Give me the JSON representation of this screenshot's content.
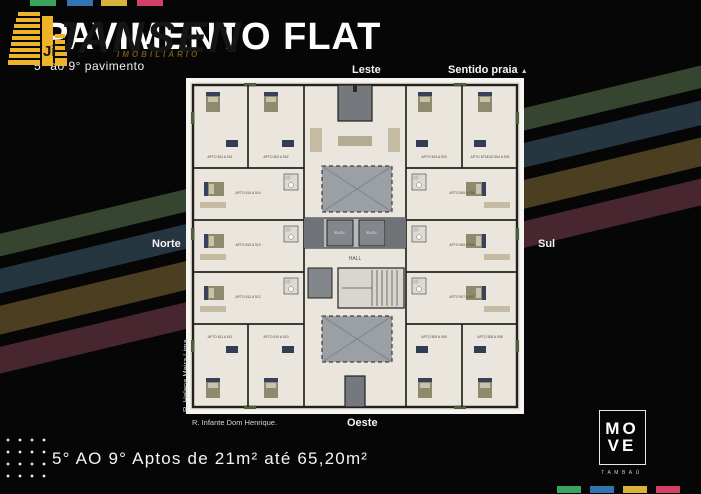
{
  "slide": {
    "title": "PAVIMENTO FLAT",
    "subtitle": "5° ao 9° pavimento",
    "tagline": "5° AO 9° Aptos de 21m² até 65,20m²"
  },
  "watermark": {
    "name": "JANSEN",
    "tagline": "IMOBILIÁRIO",
    "building_icon_color": "#edb427"
  },
  "plan": {
    "labels": {
      "top": "Leste",
      "top_right": "Sentido praia",
      "top_right_arrow": "▲",
      "left": "Norte",
      "right": "Sul",
      "bottom": "Oeste",
      "street_bottom": "R. Infante Dom Henrique.",
      "street_left": "R. Helena Meira Lima."
    },
    "core": {
      "hall": "HALL",
      "elevator1": "ELEV.",
      "elevator2": "ELEV."
    },
    "units": [
      "APTO 501 A 901",
      "APTO 502 A 902",
      "APTO 503 A 903",
      "APTO STUDIO 504 A 904",
      "APTO 505 A 905",
      "APTO 506 A 906",
      "APTO 507 A 907",
      "APTO 508 A 908",
      "APTO 509 A 909",
      "APTO 510 A 910",
      "APTO 511 A 911",
      "APTO 512 A 912",
      "APTO 513 A 913",
      "APTO 514 A 914"
    ]
  },
  "logo_move": {
    "line1": "MO",
    "line2": "VE",
    "subtitle": "TAMBAÚ"
  },
  "colors": {
    "brand_green": "#3aa45e",
    "brand_blue": "#3273b1",
    "brand_yellow": "#d8b23a",
    "brand_pink": "#d44067",
    "stripe_green": "#35452f",
    "stripe_blue": "#263640",
    "stripe_yellow": "#4c3e20",
    "stripe_maroon": "#47262f",
    "plan_paper": "#eae6de",
    "plan_core_gray": "#9ba0a5"
  }
}
